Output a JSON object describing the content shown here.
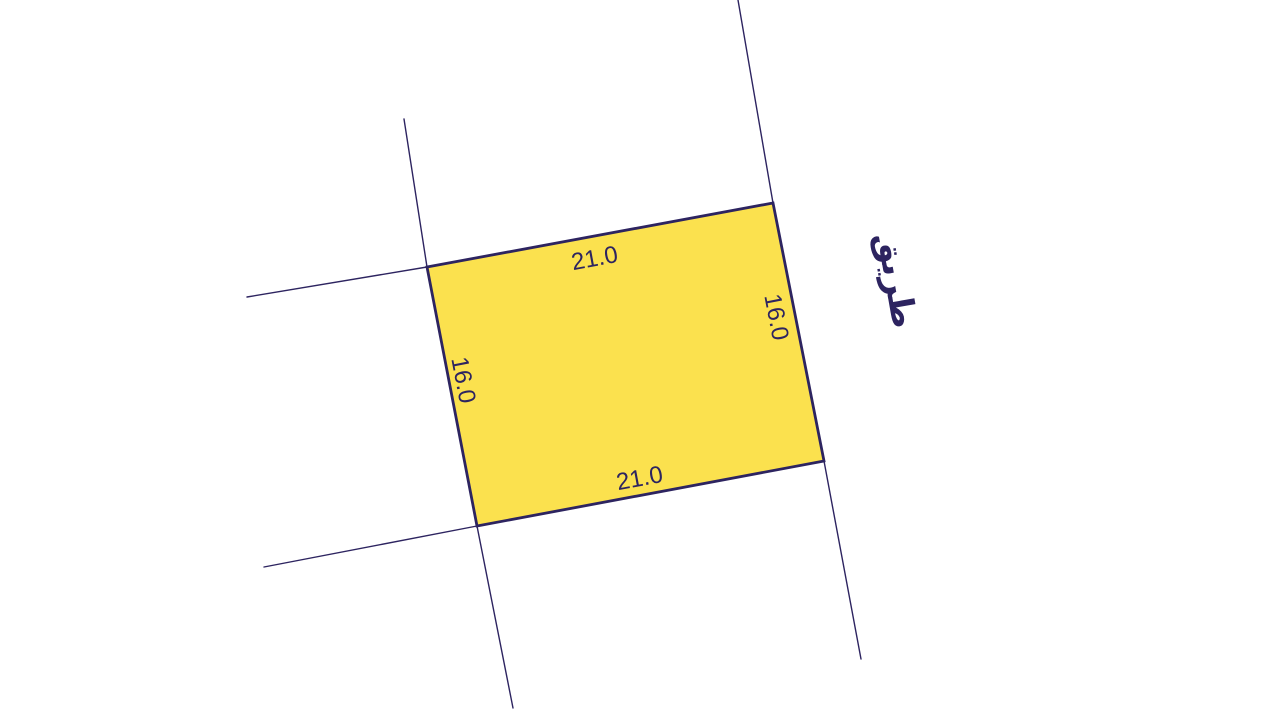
{
  "map": {
    "parcel": {
      "fill_color": "#fbe14e",
      "outline_color": "#2d2460",
      "dimensions": {
        "top": "21.0",
        "bottom": "21.0",
        "left": "16.0",
        "right": "16.0"
      }
    },
    "road": {
      "label": "طريق"
    },
    "colors": {
      "boundary_line": "#2d2460",
      "text": "#2d2460",
      "background": "#ffffff"
    }
  }
}
